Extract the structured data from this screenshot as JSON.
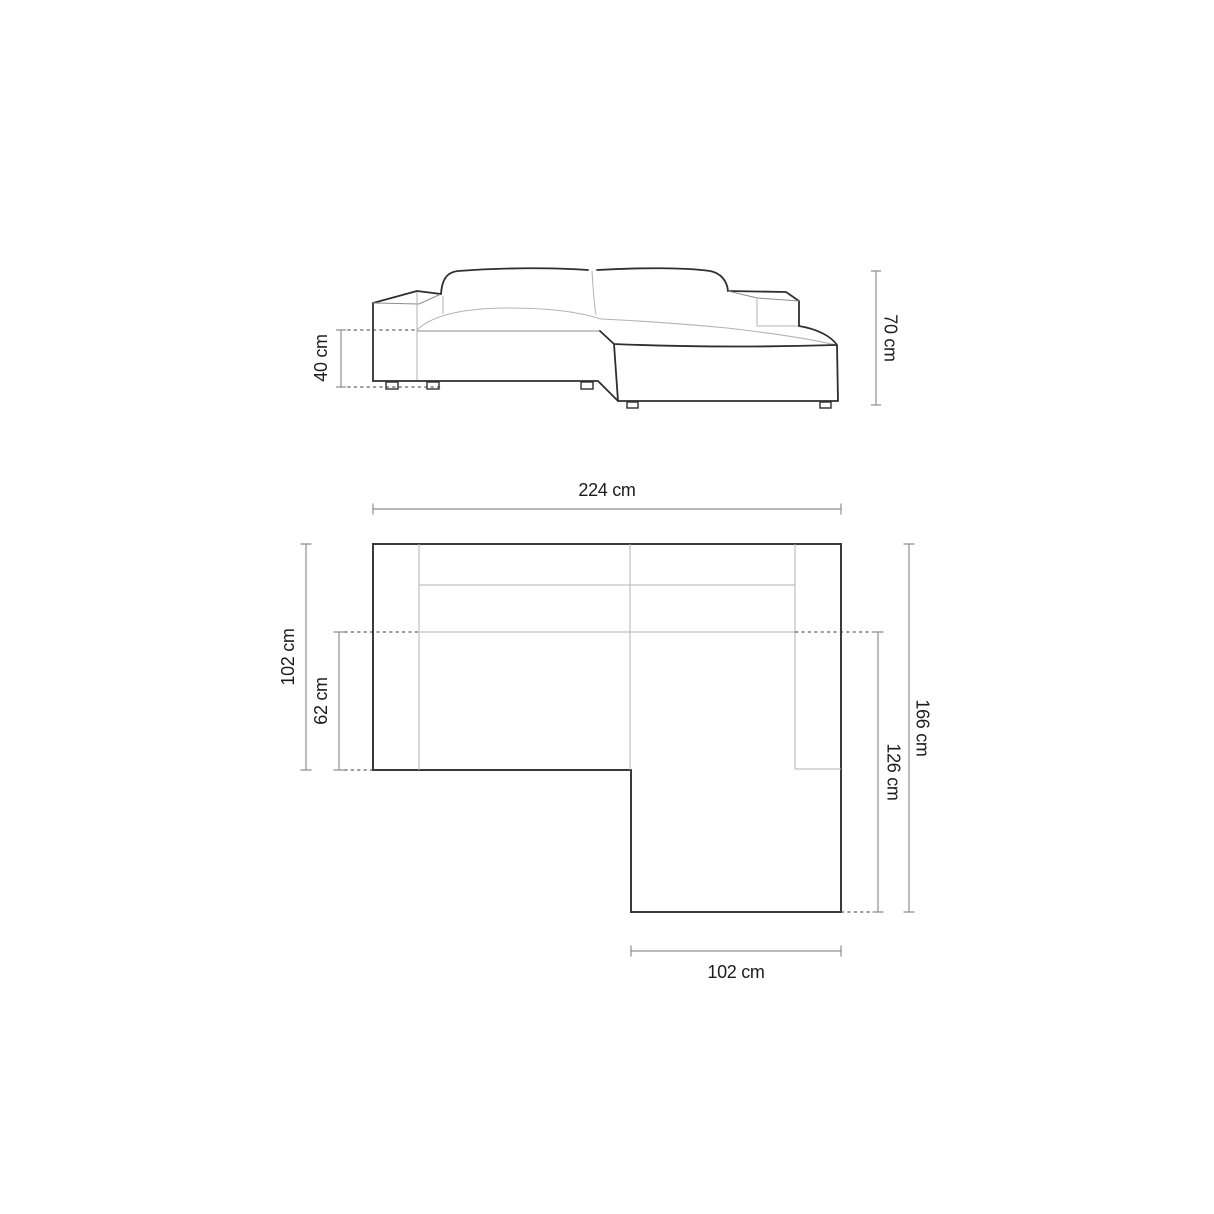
{
  "diagram": {
    "kind": "furniture dimension drawing",
    "subject": "corner sofa with chaise",
    "colors": {
      "background": "#ffffff",
      "outline": "#2f2f2f",
      "soft_line": "#b3b3b3",
      "dim_line": "#8f8f8f",
      "label_text": "#1c1c1c"
    },
    "elevation": {
      "view": "front elevation",
      "dimensions": [
        {
          "id": "seat-height",
          "label": "40 cm",
          "value": 40,
          "unit": "cm",
          "orientation": "vertical",
          "position": "left"
        },
        {
          "id": "overall-height",
          "label": "70 cm",
          "value": 70,
          "unit": "cm",
          "orientation": "vertical",
          "position": "right"
        }
      ]
    },
    "plan": {
      "view": "top plan",
      "dimensions": [
        {
          "id": "overall-width",
          "label": "224 cm",
          "value": 224,
          "unit": "cm",
          "orientation": "horizontal",
          "position": "top"
        },
        {
          "id": "body-depth",
          "label": "102 cm",
          "value": 102,
          "unit": "cm",
          "orientation": "vertical",
          "position": "left"
        },
        {
          "id": "seat-depth",
          "label": "62 cm",
          "value": 62,
          "unit": "cm",
          "orientation": "vertical",
          "position": "left-inner"
        },
        {
          "id": "overall-depth",
          "label": "166 cm",
          "value": 166,
          "unit": "cm",
          "orientation": "vertical",
          "position": "right"
        },
        {
          "id": "chaise-depth",
          "label": "126 cm",
          "value": 126,
          "unit": "cm",
          "orientation": "vertical",
          "position": "right-inner"
        },
        {
          "id": "chaise-width",
          "label": "102 cm",
          "value": 102,
          "unit": "cm",
          "orientation": "horizontal",
          "position": "bottom"
        }
      ]
    }
  }
}
